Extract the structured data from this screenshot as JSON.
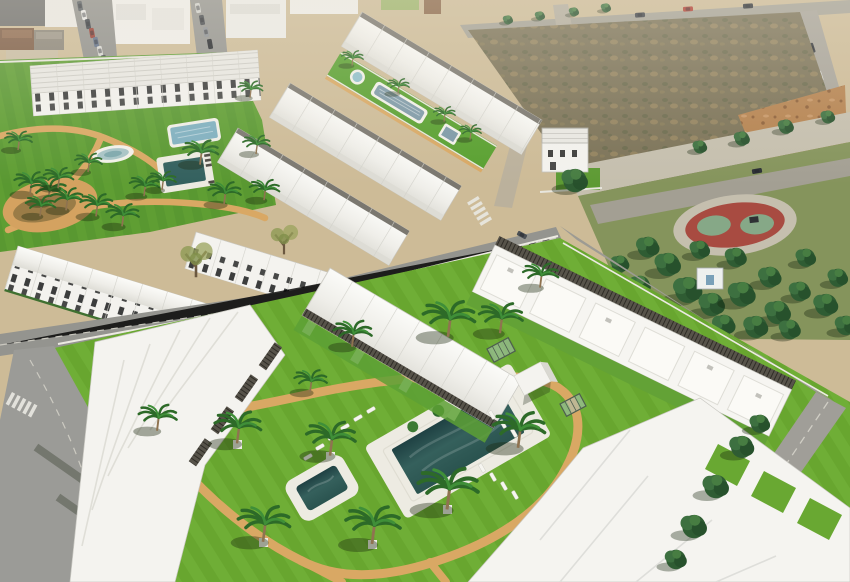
{
  "meta": {
    "title": "Aerial 3D render of a Mediterranean residential development",
    "image_type": "architectural visualization composited over an aerial photograph",
    "canvas": {
      "width": 850,
      "height": 582
    },
    "visible_text": "none"
  },
  "scene": {
    "description": "High-angle aerial render of a new-build white residential complex on the edge of a coastal town: rows of modern white townhouses and apartment blocks with dark pergolas, striped green lawns, curved sand-coloured walkways, palm trees, swimming pools, a vacant scrub lot, a tree-filled public park with a red play court, and surrounding grey roads with cars and crosswalks.",
    "lighting": "bright daylight, shadows falling toward the lower left",
    "haze": "slight atmospheric haze toward the top of the frame"
  },
  "foreground_complex": {
    "buildings": "three rows of white apartment blocks with roof terraces, dark slatted pergolas and white stairs",
    "main_pool": {
      "shape": "rectangle",
      "deck_color": "#edebe2",
      "water_color": "#2c5552",
      "planters": 4
    },
    "kids_pool": {
      "shape": "rounded square",
      "deck_color": "#edebe2",
      "water_color": "#2c5552"
    },
    "sun_loungers": 13,
    "palm_trees": 13,
    "kiosk": "small white cube pavilion",
    "glass_frames": 2,
    "paths": "looping tan walkways through mown striped lawn"
  },
  "upper_left_complex": {
    "buildings": "rows of white townhouses with dark windows and open balconies",
    "features": [
      "white-rimmed oval pond",
      "light blue rectangular pool",
      "dark plunge pool with dark loungers",
      "tan palm plaza",
      "curved tan paths"
    ],
    "palm_trees": 16
  },
  "upper_middle_complex": {
    "buildings": "three parallel rows of gabled white townhouses flanking a long lawn strip",
    "features": [
      "round spa",
      "long freeform lap pool",
      "small square pool",
      "tan edge path"
    ]
  },
  "town": {
    "blocks": "white flat-roofed buildings and houses with brown pitched roofs",
    "streets_with_parked_cars": 2,
    "parked_cars": 11,
    "moving_cars": 8,
    "car_colors": [
      "red",
      "white",
      "silver",
      "dark grey",
      "blue-grey"
    ]
  },
  "vacant_lot": {
    "surface": "olive scrub over bare earth",
    "clay_patch": "orange graded earth at the right"
  },
  "public_park": {
    "trees": "dense dark pines",
    "play_court": {
      "shape": "oval ring",
      "ring_color": "#a84b41",
      "pad_color": "#86a887"
    },
    "promenade": "light paved band along the top"
  },
  "detached_villa": "white two-storey house with grey slatted roof and small lawn",
  "roads": {
    "crosswalks": 2,
    "lane_dashes": true,
    "white_turn_arrows": 1
  },
  "palette": {
    "lawn": "#6fae36",
    "lawn_dark": "#68a62f",
    "park_grass": "#5f9e33",
    "olive_grass": "#85945c",
    "sand": "#cdbb97",
    "dirt": "#7b7257",
    "clay": "#b5824f",
    "road": "#9a9a96",
    "road_light": "#b5afa1",
    "path": "#d9a864",
    "building_white": "#f4f3ef",
    "roof_shadow": "#deddd6",
    "pergola": "#57534a",
    "pool_deep": "#2c5552",
    "pool_light": "#7fb0c0",
    "pond": "#a8c4c6",
    "court_red": "#a84b41",
    "court_pad": "#86a887",
    "tree": "#2f5c33",
    "palm": "#2d6a28",
    "trunk": "#8f7350",
    "car_red": "#b03a2e"
  }
}
